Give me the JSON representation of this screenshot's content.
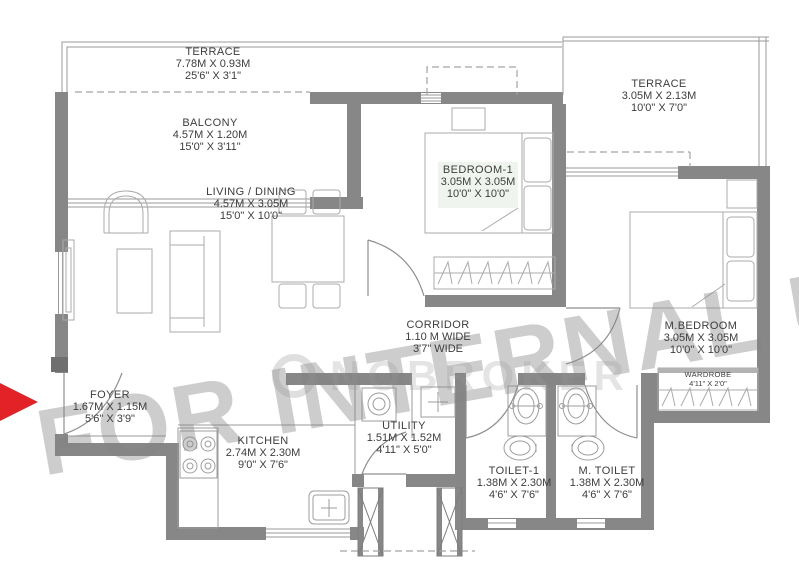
{
  "watermark": {
    "text": "FOR INTERNAL US",
    "logo_text": "NOBROKER"
  },
  "entry_arrow": {
    "color": "#e32228",
    "direction": "right"
  },
  "colors": {
    "wall": "#878787",
    "line": "#9a9a9a",
    "text": "#3d3d3d",
    "watermark": "#c6c6c6",
    "arrow": "#e32228"
  },
  "rooms": {
    "terrace_top": {
      "name": "TERRACE",
      "metric": "7.78M X 0.93M",
      "imperial": "25'6\" X 3'1\""
    },
    "balcony": {
      "name": "BALCONY",
      "metric": "4.57M X 1.20M",
      "imperial": "15'0\" X 3'11\""
    },
    "living": {
      "name": "LIVING / DINING",
      "metric": "4.57M X 3.05M",
      "imperial": "15'0\" X 10'0\""
    },
    "bedroom1": {
      "name": "BEDROOM-1",
      "metric": "3.05M X 3.05M",
      "imperial": "10'0\" X 10'0\""
    },
    "terrace_right": {
      "name": "TERRACE",
      "metric": "3.05M X 2.13M",
      "imperial": "10'0\" X 7'0\""
    },
    "mbedroom": {
      "name": "M.BEDROOM",
      "metric": "3.05M X 3.05M",
      "imperial": "10'0\" X 10'0\""
    },
    "corridor": {
      "name": "CORRIDOR",
      "metric": "1.10 M WIDE",
      "imperial": "3'7\" WIDE"
    },
    "foyer": {
      "name": "FOYER",
      "metric": "1.67M X 1.15M",
      "imperial": "5'6\" X 3'9\""
    },
    "kitchen": {
      "name": "KITCHEN",
      "metric": "2.74M X 2.30M",
      "imperial": "9'0\" X 7'6\""
    },
    "utility": {
      "name": "UTILITY",
      "metric": "1.51M X 1.52M",
      "imperial": "4'11\" X 5'0\""
    },
    "toilet1": {
      "name": "TOILET-1",
      "metric": "1.38M X 2.30M",
      "imperial": "4'6\" X 7'6\""
    },
    "mtoilet": {
      "name": "M. TOILET",
      "metric": "1.38M X 2.30M",
      "imperial": "4'6\" X 7'6\""
    },
    "wardrobe": {
      "name": "WARDROBE",
      "imperial": "4'11\" X 2'0\""
    }
  }
}
